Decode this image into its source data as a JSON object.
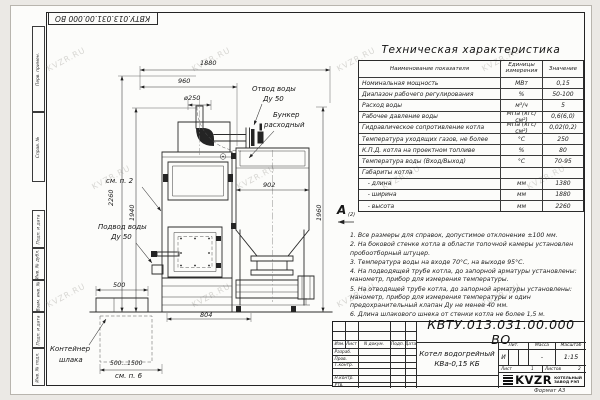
{
  "watermark": {
    "text": "KVZR.RU"
  },
  "frame": {
    "format_label": "Формат А3",
    "side_columns": [
      "Перв. примен.",
      "Справ. №",
      "Подп. и дата",
      "Инв. № дубл.",
      "Взам. инв. №",
      "Подп. и дата",
      "Инв. № подл."
    ]
  },
  "drawing": {
    "dims": {
      "overall_width": "1880",
      "left_width": "960",
      "chimney_dia": "ø250",
      "hopper_width": "902",
      "right_height": "1960",
      "total_height": "2260",
      "mid_height": "1940",
      "base_width": "804",
      "container_width": "500",
      "container_travel": "500...1500"
    },
    "labels": {
      "outlet_line1": "Отвод воды",
      "outlet_line2": "Ду 50",
      "hopper_line1": "Бункер",
      "hopper_line2": "расходный",
      "see_note2": "см. п. 2",
      "inlet_line1": "Подвод воды",
      "inlet_line2": "Ду 50",
      "container_line1": "Контейнер",
      "container_line2": "шлака",
      "see_note6": "см. п. 6"
    },
    "view": {
      "letter": "А",
      "sheet_ref": "(2)"
    }
  },
  "spec_table": {
    "title": "Техническая характеристика",
    "headers": [
      "Наименование показателя",
      "Единицы измерения",
      "Значение"
    ],
    "rows": [
      [
        "Номинальная мощность",
        "МВт",
        "0,15"
      ],
      [
        "Диапазон рабочего регулирования",
        "%",
        "50-100"
      ],
      [
        "Расход воды",
        "м³/ч",
        "5"
      ],
      [
        "Рабочее давление воды",
        "МПа (кгс/см²)",
        "0,6(6,0)"
      ],
      [
        "Гидравлическое сопротивление котла",
        "МПа (кгс/см²)",
        "0,02(0,2)"
      ],
      [
        "Температура уходящих газов, не более",
        "°С",
        "250"
      ],
      [
        "К.П.Д. котла на проектном топливе",
        "%",
        "80"
      ],
      [
        "Температура воды (Вход/Выход)",
        "°С",
        "70-95"
      ],
      [
        "Габариты котла",
        "",
        ""
      ],
      [
        "   - длина",
        "мм",
        "1380"
      ],
      [
        "   - ширина",
        "мм",
        "1880"
      ],
      [
        "   - высота",
        "мм",
        "2260"
      ]
    ]
  },
  "notes": {
    "items": [
      "1. Все размеры для справок, допустимое отклонение ±100 мм.",
      "2. На боковой стенке котла в области топочной камеры установлен пробоотборный штуцер.",
      "3. Температура воды на входе 70°С, на выходе 95°С.",
      "4. На подводящей трубе котла, до запорной арматуры установлены: манометр, прибор для измерения температуры.",
      "5. На отводящей трубе котла, до запорной арматуры установлены: манометр, прибор для измерения температуры и один предохранительный клапан Ду не менее 40 мм.",
      "6. Длина шлакового шнека от стенки котла не более 1,5 м.",
      "7. Остальные технические требования по ОСТ 108.030.133-84."
    ]
  },
  "title_block": {
    "designation": "КВТУ.013.031.00.000 ВО",
    "doc_name_1": "Котел водогрейный",
    "doc_name_2": "КВа-0,15 КБ",
    "header_cells": [
      "Изм.",
      "Лист",
      "N докум.",
      "Подп.",
      "Дата"
    ],
    "row_labels": [
      "Разраб.",
      "Пров.",
      "Т.контр.",
      "",
      "Н.контр.",
      "Утв."
    ],
    "lit_header": "Лит.",
    "lit_value": "И",
    "mass_header": "Масса",
    "mass_value": "-",
    "scale_header": "Масштаб",
    "scale_value": "1:15",
    "sheet_label": "Лист",
    "sheet_value": "1",
    "sheets_label": "Листов",
    "sheets_value": "2",
    "company_logo": "KVZR",
    "company_line_1": "КОТЕЛЬНЫЙ",
    "company_line_2": "ЗАВОД РЭП"
  }
}
